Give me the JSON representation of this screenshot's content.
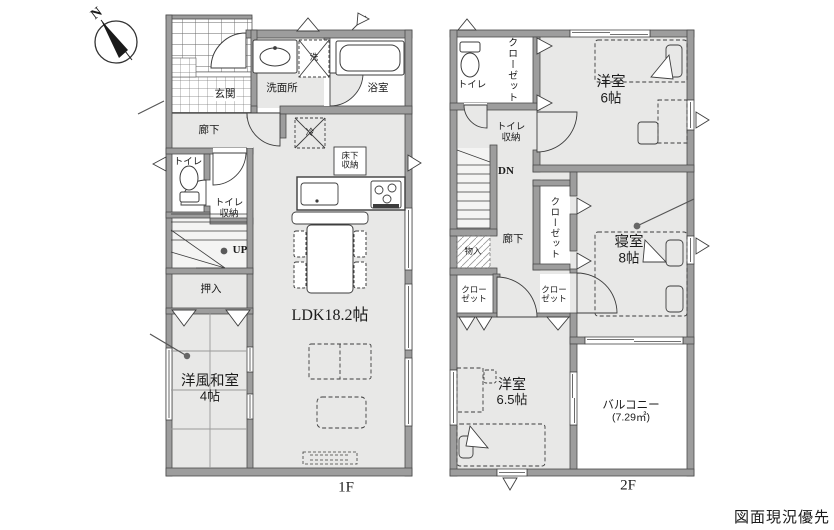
{
  "compass": {
    "north_label": "N"
  },
  "floor1": {
    "floor_label": "1F",
    "rooms": {
      "genkan": "玄関",
      "rouka": "廊下",
      "toilet": "トイレ",
      "toilet_storage_line1": "トイレ",
      "toilet_storage_line2": "収納",
      "stairs_up": "UP",
      "oshiire": "押入",
      "washitsu_line1": "洋風和室",
      "washitsu_line2": "4帖",
      "senmenjo": "洗面所",
      "bathroom": "浴室",
      "washer": "洗",
      "fridge": "冷",
      "underfloor_line1": "床下",
      "underfloor_line2": "収納",
      "ldk": "LDK18.2帖"
    }
  },
  "floor2": {
    "floor_label": "2F",
    "rooms": {
      "toilet": "トイレ",
      "closet_top": "クローゼット",
      "toilet_storage_line1": "トイレ",
      "toilet_storage_line2": "収納",
      "stairs_down": "DN",
      "rouka": "廊下",
      "mono_ire": "物入",
      "closet_mid": "クローゼット",
      "closet_bl_line1": "クロー",
      "closet_bl_line2": "ゼット",
      "closet_bm_line1": "クロー",
      "closet_bm_line2": "ゼット",
      "yoshitsu6_line1": "洋室",
      "yoshitsu6_line2": "6帖",
      "shinshitsu_line1": "寝室",
      "shinshitsu_line2": "8帖",
      "yoshitsu65_line1": "洋室",
      "yoshitsu65_line2": "6.5帖",
      "balcony_line1": "バルコニー",
      "balcony_line2": "(7.29㎡)"
    }
  },
  "footer": {
    "note": "図面現況優先"
  },
  "colors": {
    "wall": "#9d9d9d",
    "room_fill": "#e8e8e7",
    "line": "#3d3d3d",
    "text": "#1b1b1b"
  }
}
